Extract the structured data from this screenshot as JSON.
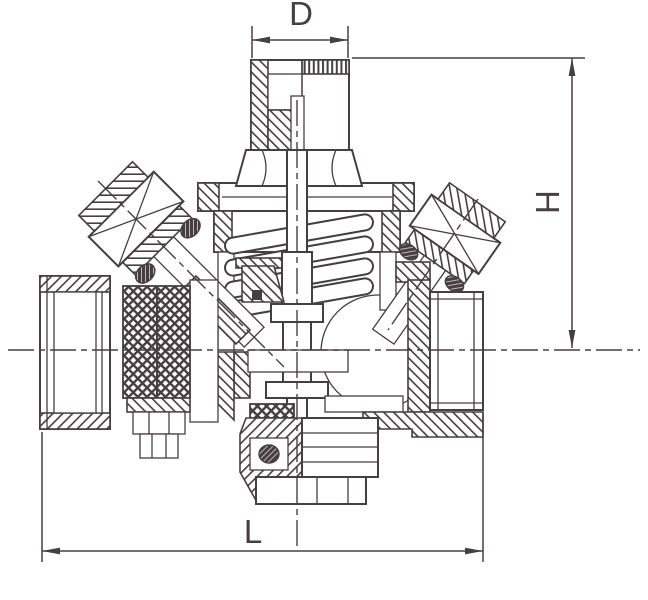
{
  "figure": {
    "labels": {
      "diameter": "D",
      "height": "H",
      "length": "L"
    },
    "colors": {
      "line": "#463e41",
      "background": "#ffffff"
    }
  }
}
